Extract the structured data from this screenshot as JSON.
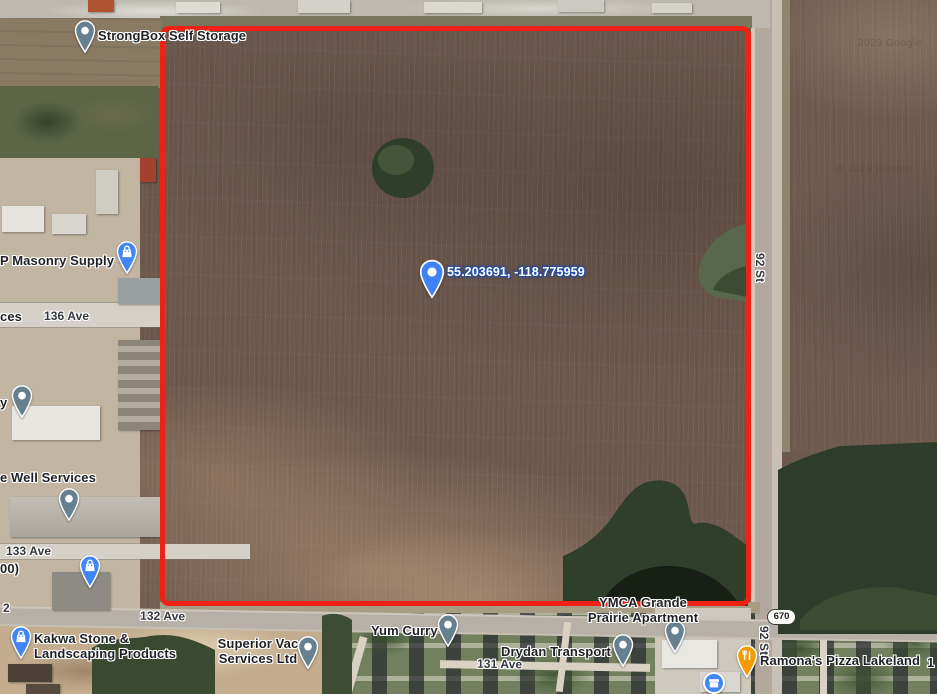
{
  "map": {
    "watermark_top": "2023 Google",
    "watermark_mid": "© 2023 Google"
  },
  "labels": {
    "strongbox": "StrongBox Self Storage",
    "masonry_supply": "P Masonry Supply",
    "coordinates": "55.203691, -118.775959",
    "partial_ces": "ces",
    "ave_136": "136 Ave",
    "partial_y": "y",
    "well_services": "e Well Services",
    "ave_133": "133 Ave",
    "partial_00": "00)",
    "partial_2": "2",
    "ave_132": "132 Ave",
    "kakwa_line1": "Kakwa Stone &",
    "kakwa_line2": "Landscaping Products",
    "superior_line1": "Superior Vac",
    "superior_line2": "Services Ltd",
    "yum_curry": "Yum Curry",
    "drydan": "Drydan Transport",
    "ave_131": "131 Ave",
    "ymca_line1": "YMCA Grande",
    "ymca_line2": "Prairie Apartment",
    "route_670": "670",
    "st_92_upper": "92 St",
    "st_92_lower": "92 St",
    "ramonas": "Ramona's Pizza Lakeland",
    "partial_1": "1"
  },
  "colors": {
    "boundary_red": "#ee2114",
    "pin_blue": "#4285f4",
    "pin_grey": "#66808f",
    "pin_orange": "#f59b00"
  }
}
